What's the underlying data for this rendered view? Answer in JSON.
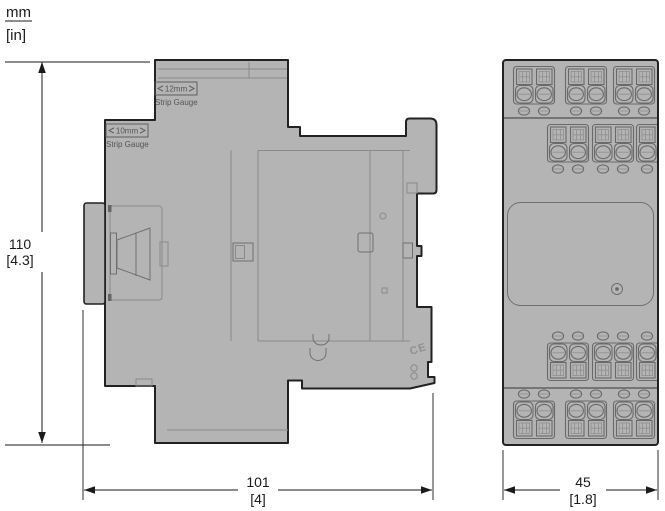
{
  "units": {
    "primary": "mm",
    "secondary": "[in]"
  },
  "dimensions": {
    "height": {
      "mm": "110",
      "in": "[4.3]"
    },
    "depth": {
      "mm": "101",
      "in": "[4]"
    },
    "width": {
      "mm": "45",
      "in": "[1.8]"
    }
  },
  "labels": {
    "strip_gauge_12": {
      "value": "12mm",
      "caption": "Strip Gauge"
    },
    "strip_gauge_10": {
      "value": "10mm",
      "caption": "Strip Gauge"
    },
    "ce_mark": "CE"
  },
  "colors": {
    "body": "#b4b4b4",
    "outline": "#222222",
    "detail": "#8a8a8a",
    "dimension": "#1a1a1a"
  }
}
